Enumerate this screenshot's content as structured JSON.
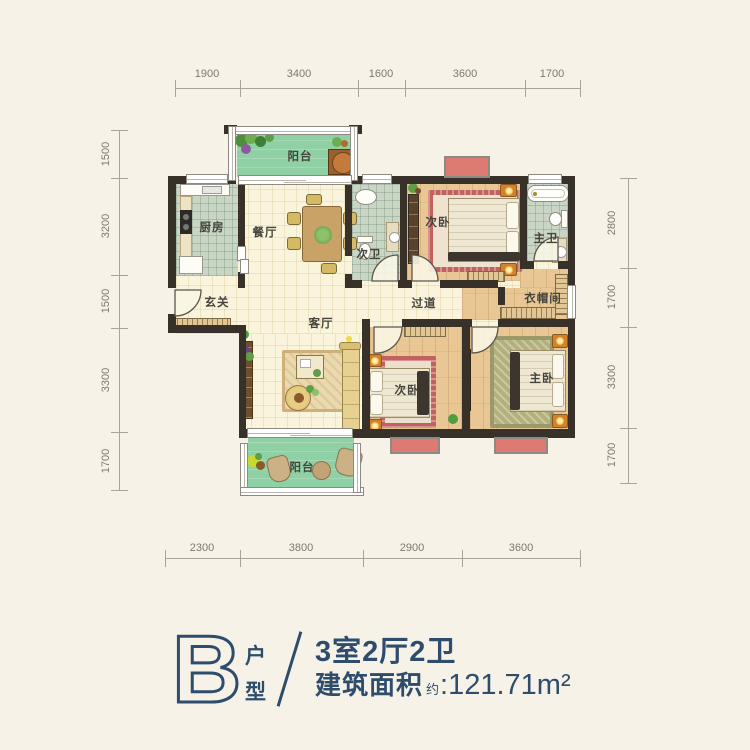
{
  "dims": {
    "top": [
      "1900",
      "3400",
      "1600",
      "3600",
      "1700"
    ],
    "left": [
      "1500",
      "3200",
      "1500",
      "3300",
      "1700"
    ],
    "right": [
      "2800",
      "1700",
      "3300",
      "1700"
    ],
    "bottom": [
      "2300",
      "3800",
      "2900",
      "3600"
    ]
  },
  "rooms": {
    "balcony_top": "阳台",
    "kitchen": "厨房",
    "dining": "餐厅",
    "bath_second": "次卫",
    "bedroom_second_top": "次卧",
    "bath_master": "主卫",
    "entry": "玄关",
    "corridor": "过道",
    "closet": "衣帽间",
    "living": "客厅",
    "bedroom_second_bottom": "次卧",
    "bedroom_master": "主卧",
    "balcony_bottom": "阳台"
  },
  "legend": {
    "letter": "B",
    "unit_type": [
      "户",
      "型"
    ],
    "layout": "3室2厅2卫",
    "area_label": "建筑面积",
    "area_approx": "约",
    "area_value": ":121.71m²"
  },
  "colors": {
    "bg": "#f7f2e8",
    "wall": "#37312a",
    "cream": "#faf4dc",
    "tile": "#c9d6c6",
    "wood": "#e9c795",
    "green": "#8fd0a4",
    "bay": "#dd7a72",
    "navy": "#2e4d6c",
    "rugred": "#c06260",
    "rugolive": "#b2b07e"
  }
}
